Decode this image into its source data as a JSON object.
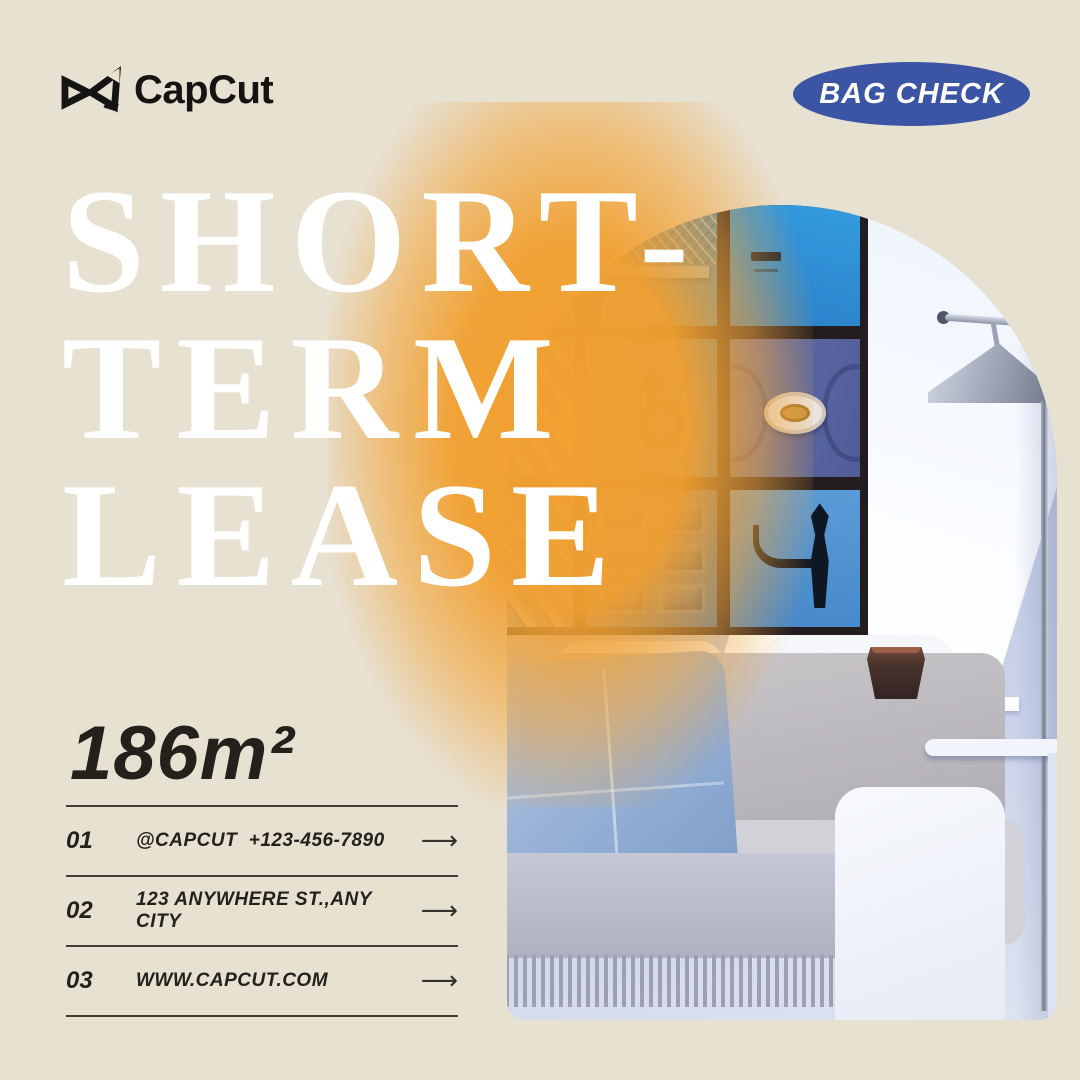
{
  "brand": {
    "logo_text": "CapCut"
  },
  "badge": {
    "label": "BAG CHECK",
    "bg_color": "#3b54a4",
    "text_color": "#ffffff"
  },
  "headline": {
    "lines": [
      "SHORT-",
      "TERM",
      "LEASE"
    ],
    "color": "#ffffff"
  },
  "area": {
    "value": "186m²"
  },
  "contact_rows": [
    {
      "index": "01",
      "text": "@CAPCUT  +123-456-7890",
      "arrow": "⟶"
    },
    {
      "index": "02",
      "text": "123 ANYWHERE ST.,ANY CITY",
      "arrow": "⟶"
    },
    {
      "index": "03",
      "text": "WWW.CAPCUT.COM",
      "arrow": "⟶"
    }
  ],
  "photo": {
    "alt": "Arched photo of a living room: gallery wall of nine framed blue door photos, metal cone floor lamp, white sofa with light-blue pillow and fringed grey throw, white side tables with dark faceted planter"
  },
  "colors": {
    "background_beige": "#e7e1d2",
    "accent_orange": "#f1a031",
    "badge_blue": "#3b54a4",
    "text_dark": "#23211c",
    "wall_periwinkle": "#bfc9e2"
  }
}
